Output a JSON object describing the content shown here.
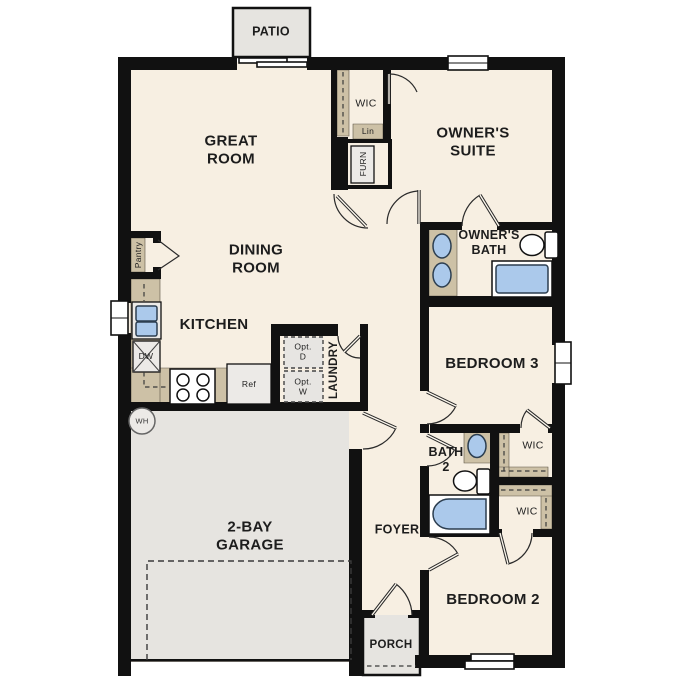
{
  "plan_labels": {
    "patio": "PATIO",
    "great_room": "GREAT\nROOM",
    "wic_owner": "WIC",
    "linen": "Lin",
    "furnace": "FURN",
    "owners_suite": "OWNER'S\nSUITE",
    "dining_room": "DINING\nROOM",
    "pantry": "Pantry",
    "owners_bath": "OWNER'S\nBATH",
    "kitchen": "KITCHEN",
    "dishwasher": "DW",
    "refrigerator": "Ref",
    "opt_dryer": "Opt.\nD",
    "opt_washer": "Opt.\nW",
    "laundry": "LAUNDRY",
    "bedroom3": "BEDROOM 3",
    "water_heater": "WH",
    "bath2": "BATH\n2",
    "wic_bed3": "WIC",
    "garage": "2-BAY\nGARAGE",
    "foyer": "FOYER",
    "wic_bed2": "WIC",
    "bedroom2": "BEDROOM 2",
    "porch": "PORCH"
  },
  "colors": {
    "wall": "#111111",
    "floor": "#f7efe2",
    "paved": "#e6e4e0",
    "counter": "#cdc1a6",
    "fixture": "#abc9eb",
    "appliance": "#eceae7"
  }
}
